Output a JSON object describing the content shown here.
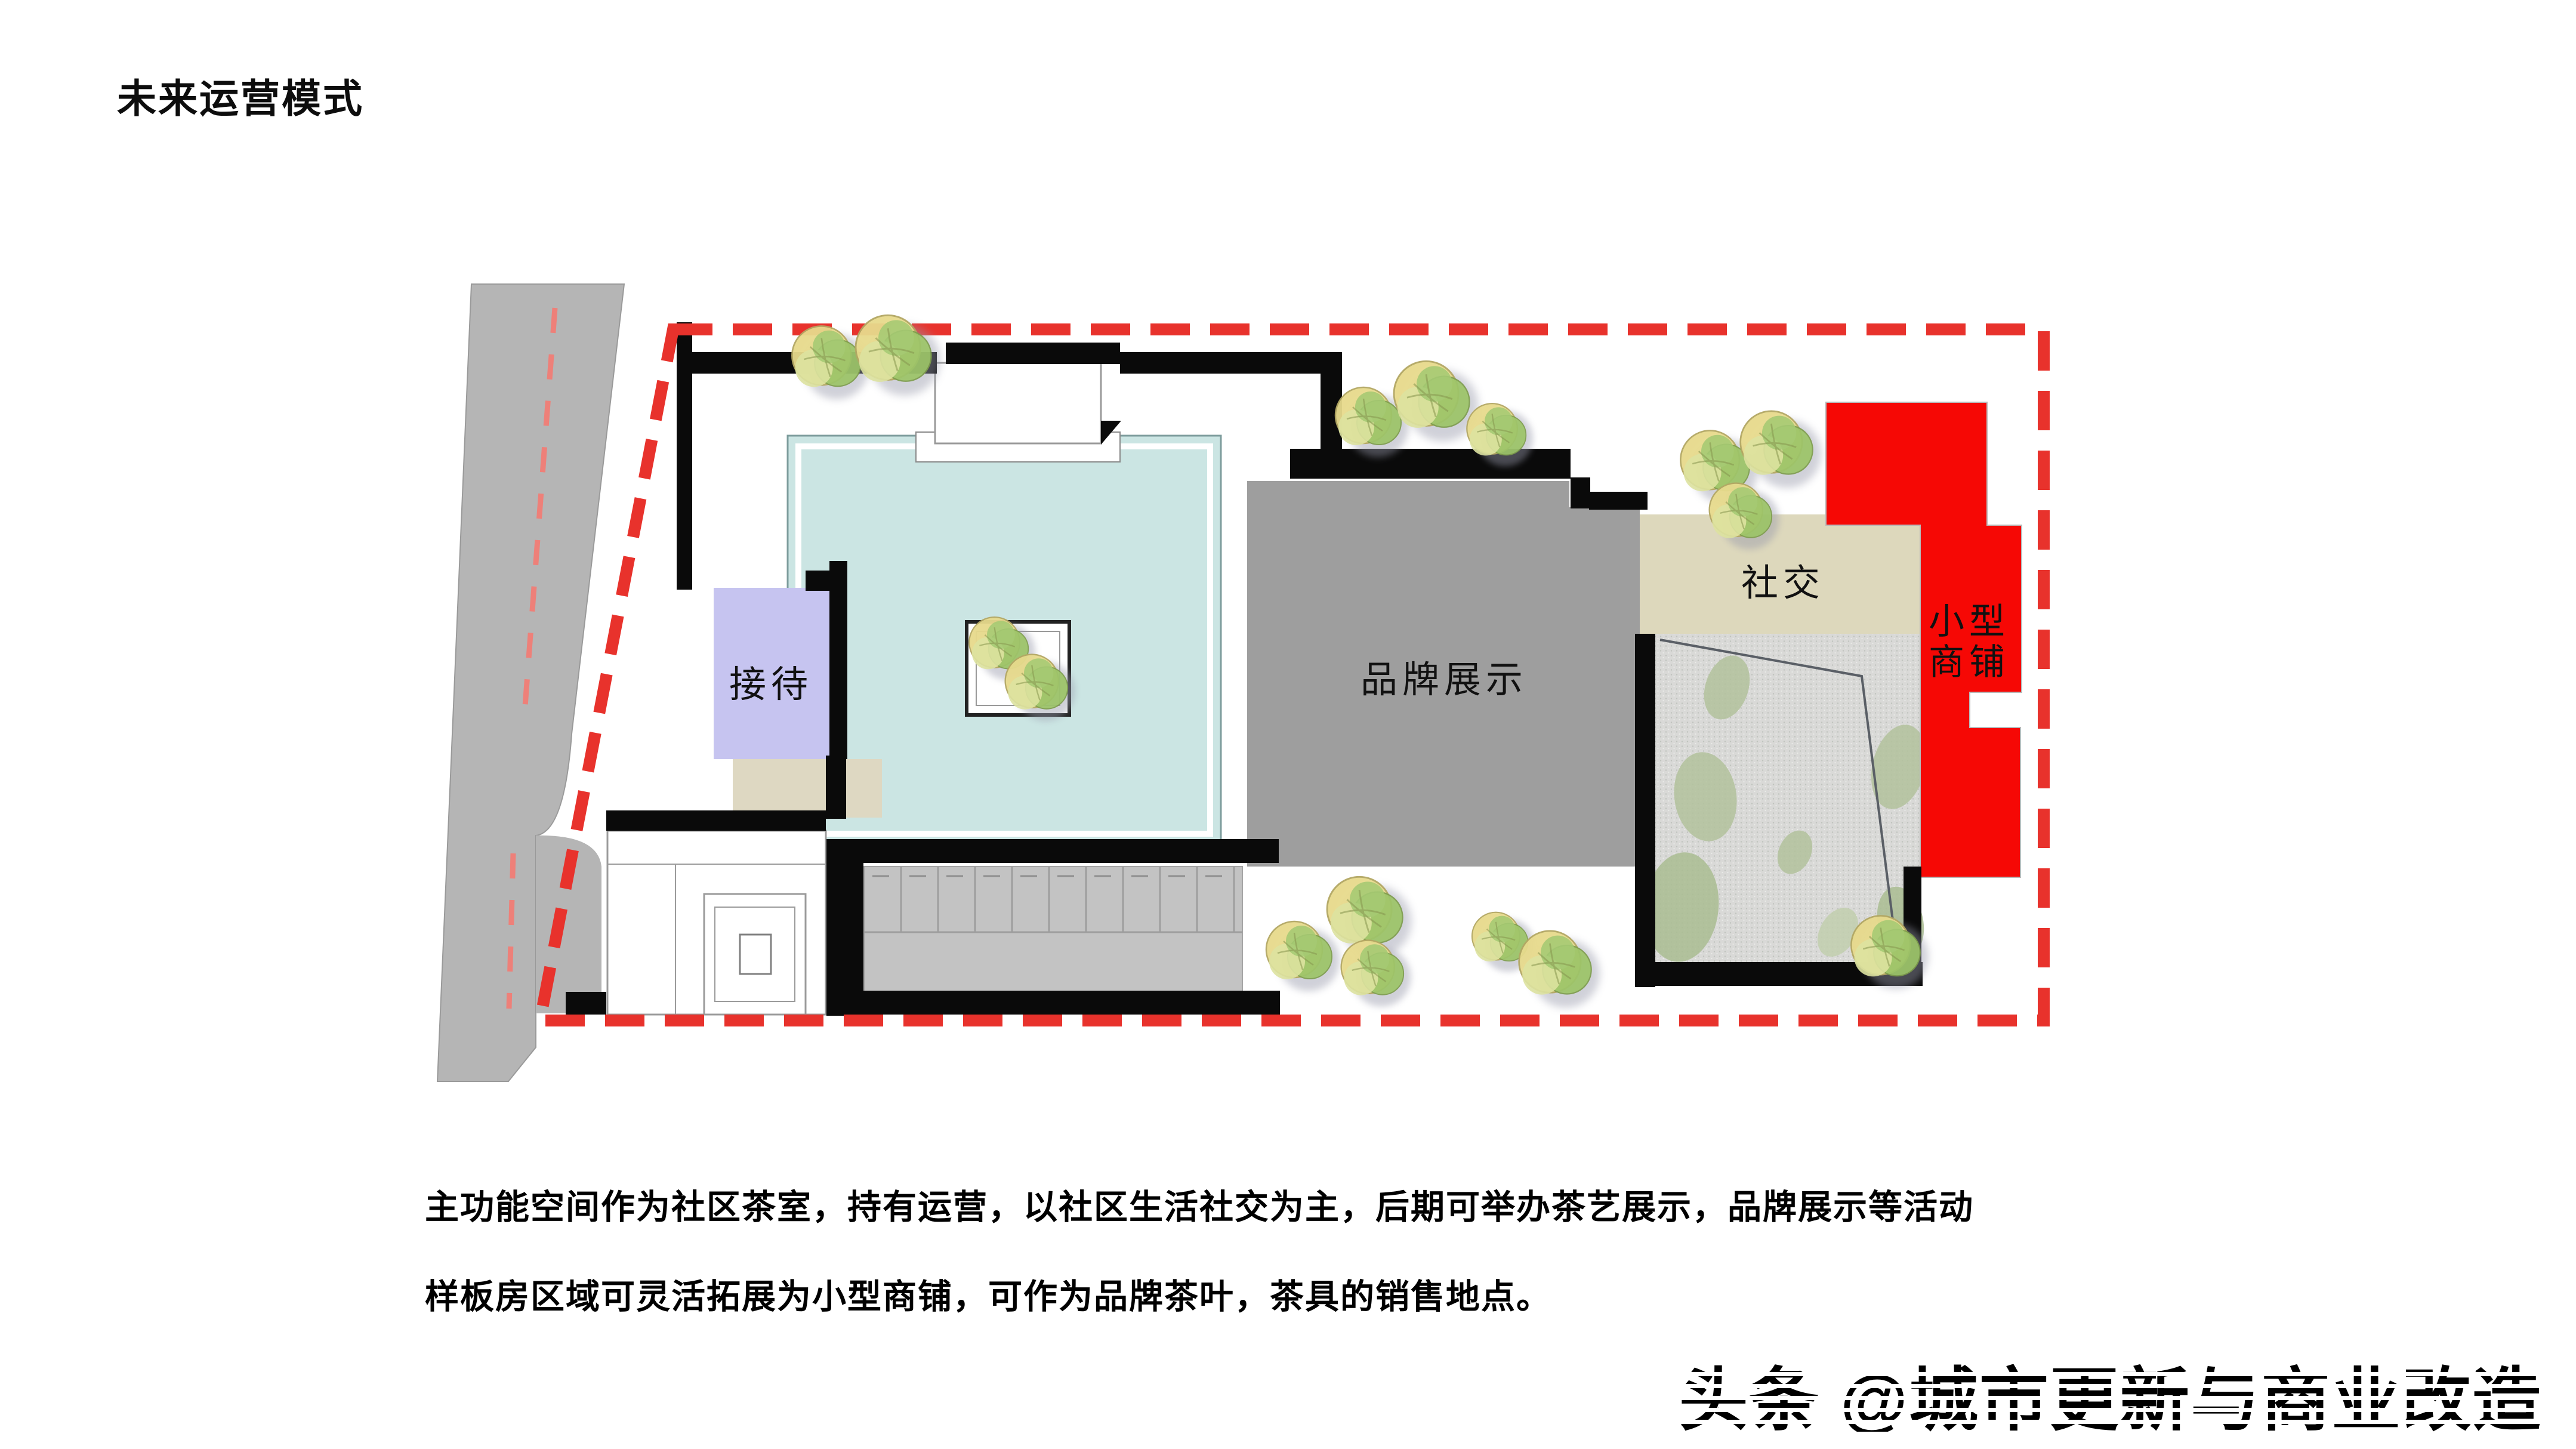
{
  "page": {
    "title": "未来运营模式"
  },
  "plan": {
    "rooms": {
      "reception": "接待",
      "brand_display": "品牌展示",
      "social": "社交",
      "shop_line1": "小型",
      "shop_line2": "商铺"
    },
    "colors": {
      "wall": "#0a0a0a",
      "road": "#b5b5b5",
      "road_centerline": "#ee8079",
      "boundary": "#e8322c",
      "tea_room": "#cbe5e3",
      "reception": "#c6c4f0",
      "reception_annex": "#ded8c2",
      "brand_display": "#9e9e9e",
      "social": "#ddd8bc",
      "courtyard": "#d9d9d7",
      "shop": "#f60805",
      "deck": "#c3c3c3"
    }
  },
  "description": {
    "line1": "主功能空间作为社区茶室，持有运营，以社区生活社交为主，后期可举办茶艺展示，品牌展示等活动",
    "line2": "样板房区域可灵活拓展为小型商铺，可作为品牌茶叶，茶具的销售地点。"
  },
  "watermark": {
    "text": "头条 @城市更新与商业改造"
  }
}
